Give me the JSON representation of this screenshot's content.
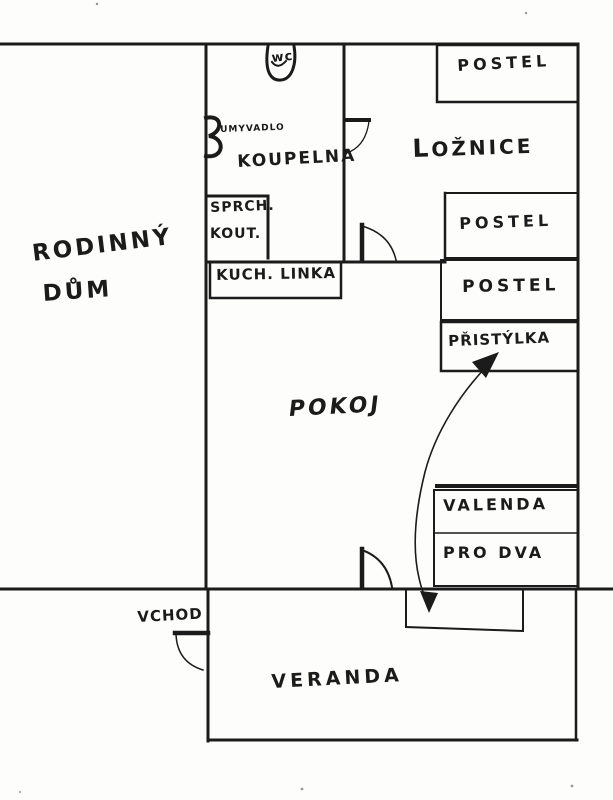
{
  "page": {
    "title": "Hand-drawn floor plan of a family house",
    "ink_color": "#1b1b1b",
    "paper_color": "#fdfdfc"
  },
  "plan": {
    "house_label": {
      "line1": "RODINNÝ",
      "line2": "DŮM"
    },
    "rooms": {
      "bathroom": {
        "label": "KOUPELNA"
      },
      "bedroom": {
        "label": "LOŽNICE"
      },
      "living": {
        "label": "POKOJ"
      },
      "veranda": {
        "label": "VERANDA"
      }
    },
    "fixtures": {
      "toilet": "wc",
      "sink": "UMYVADLO",
      "shower_line1": "SPRCH.",
      "shower_line2": "KOUT.",
      "kitchen_unit": "KUCH. LINKA",
      "entrance": "VCHOD"
    },
    "beds": {
      "bed_top": "POSTEL",
      "bed_middle": "POSTEL",
      "bed_lower": "POSTEL",
      "extra_bed": "PŘISTÝLKA",
      "daybed_line1": "VALENDA",
      "daybed_line2": "PRO DVA"
    }
  }
}
